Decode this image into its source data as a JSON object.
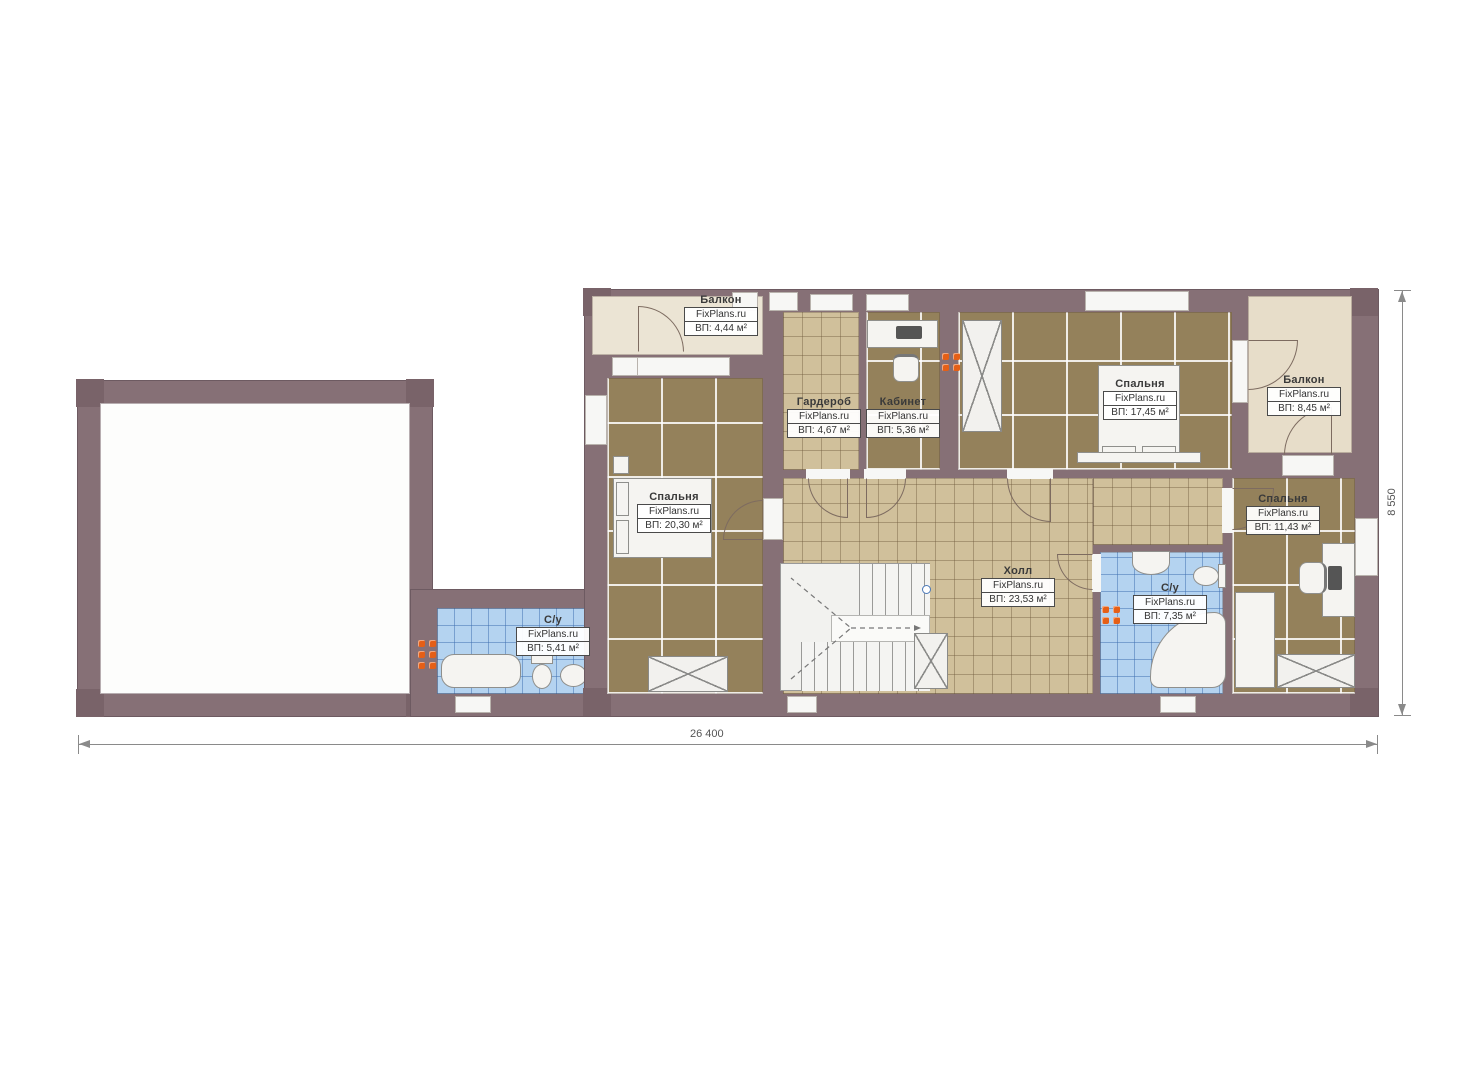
{
  "plan": {
    "brand": "FixPlans.ru",
    "type": "floor-plan-second-storey"
  },
  "rooms": [
    {
      "id": "balcony-left",
      "name": "Балкон",
      "brand": "FixPlans.ru",
      "area": "ВП: 4,44 м²"
    },
    {
      "id": "wardrobe",
      "name": "Гардероб",
      "brand": "FixPlans.ru",
      "area": "ВП: 4,67 м²"
    },
    {
      "id": "office",
      "name": "Кабинет",
      "brand": "FixPlans.ru",
      "area": "ВП: 5,36 м²"
    },
    {
      "id": "bedroom-17",
      "name": "Спальня",
      "brand": "FixPlans.ru",
      "area": "ВП: 17,45 м²"
    },
    {
      "id": "balcony-right",
      "name": "Балкон",
      "brand": "FixPlans.ru",
      "area": "ВП: 8,45 м²"
    },
    {
      "id": "bedroom-20",
      "name": "Спальня",
      "brand": "FixPlans.ru",
      "area": "ВП: 20,30 м²"
    },
    {
      "id": "bedroom-11",
      "name": "Спальня",
      "brand": "FixPlans.ru",
      "area": "ВП: 11,43 м²"
    },
    {
      "id": "hall",
      "name": "Холл",
      "brand": "FixPlans.ru",
      "area": "ВП: 23,53 м²"
    },
    {
      "id": "bath-small",
      "name": "С/у",
      "brand": "FixPlans.ru",
      "area": "ВП: 5,41 м²"
    },
    {
      "id": "bath-big",
      "name": "С/у",
      "brand": "FixPlans.ru",
      "area": "ВП: 7,35 м²"
    }
  ],
  "dimensions": {
    "bottom": "26 400",
    "right": "8 550"
  },
  "colors": {
    "wall": "#867076",
    "corner_block": "#796369",
    "carpet": "#94815b",
    "tile_tan": "#d0c09b",
    "tile_blue": "#b4d3f0",
    "balcony_left": "#ebe4d4",
    "balcony_right": "#e7ddc9",
    "radiator": "#e55f17",
    "fixture": "#f5f4f1"
  }
}
